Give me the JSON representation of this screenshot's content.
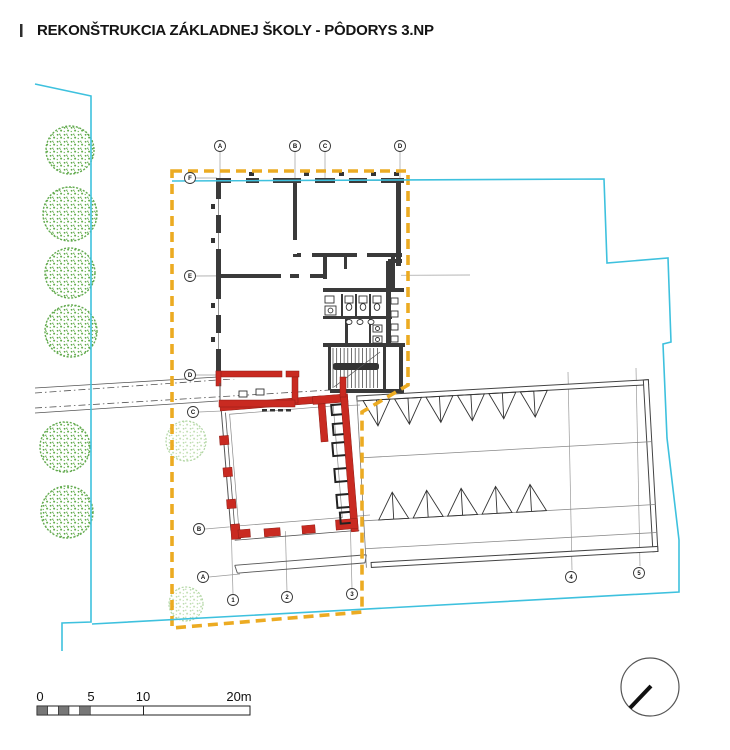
{
  "title": "REKONŠTRUKCIA ZÁKLADNEJ ŠKOLY - PÔDORYS 3.NP",
  "scale_bar": {
    "labels": [
      "0",
      "5",
      "10",
      "20m"
    ]
  },
  "grid": {
    "top": [
      "A",
      "B",
      "C",
      "D"
    ],
    "left": [
      "F",
      "E",
      "D",
      "C",
      "B",
      "A"
    ],
    "bottom": [
      "1",
      "2",
      "3"
    ],
    "right": [
      "4",
      "5"
    ]
  },
  "colors": {
    "site_boundary": "#3EC1DE",
    "renovation_boundary": "#ECAB22",
    "new_construction_walls": "#C92A21",
    "existing_walls": "#3A3A3A",
    "vegetation": "#6AAC4E"
  }
}
